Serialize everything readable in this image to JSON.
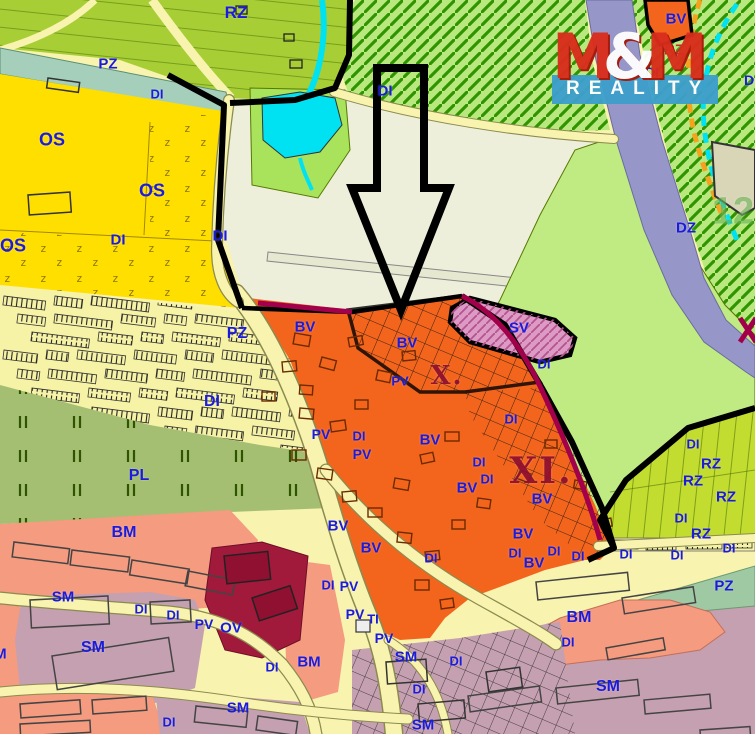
{
  "logo": {
    "m1": "M",
    "amp": "&",
    "m2": "M",
    "tagline": "REALITY"
  },
  "zone_colors": {
    "os_yellow": "#FFDF00",
    "bv_orange": "#F3651D",
    "sv_pink": "#DC9AC4",
    "sm_mauve": "#C5A0B0",
    "bm_salmon": "#F49B80",
    "ov_crimson": "#A11A3B",
    "pl_olive": "#A4BE72",
    "rz_top": "#A8CE35",
    "rz_garden": "#C3DC30",
    "dz_purple": "#9697C8",
    "pz_teal": "#A5CFBA",
    "pz_sage": "#9FC9A3",
    "cream_field": "#EDEFDA",
    "hatch_green": "#B9E87E",
    "light_green": "#BFEB82",
    "road_yellow": "#F8F3AE",
    "water_cyan": "#00E2F2",
    "label_blue": "#1B1BDC",
    "roman_red": "#8E0F30",
    "change_boundary": "#A3004B"
  },
  "labels": [
    {
      "t": "PZ",
      "x": 108,
      "y": 64
    },
    {
      "t": "DI",
      "x": 157,
      "y": 94,
      "s": 13
    },
    {
      "t": "RZ",
      "x": 236,
      "y": 13,
      "s": 17
    },
    {
      "t": "DI",
      "x": 385,
      "y": 91
    },
    {
      "t": "BV",
      "x": 676,
      "y": 19
    },
    {
      "t": "RZ",
      "x": 674,
      "y": 50,
      "c": "red"
    },
    {
      "t": "DI",
      "x": 652,
      "y": 72,
      "s": 14
    },
    {
      "t": "DI",
      "x": 751,
      "y": 80,
      "s": 14
    },
    {
      "t": "DZ",
      "x": 686,
      "y": 228
    },
    {
      "t": "OS",
      "x": 52,
      "y": 140,
      "s": 18
    },
    {
      "t": "OS",
      "x": 152,
      "y": 191,
      "s": 18
    },
    {
      "t": "OS",
      "x": 13,
      "y": 246,
      "s": 18
    },
    {
      "t": "DI",
      "x": 118,
      "y": 240
    },
    {
      "t": "DI",
      "x": 220,
      "y": 236
    },
    {
      "t": "DI",
      "x": 212,
      "y": 402,
      "s": 16
    },
    {
      "t": "PZ",
      "x": 237,
      "y": 334,
      "s": 16
    },
    {
      "t": "BV",
      "x": 305,
      "y": 327
    },
    {
      "t": "BV",
      "x": 407,
      "y": 343
    },
    {
      "t": "PV",
      "x": 400,
      "y": 381,
      "s": 13
    },
    {
      "t": "SV",
      "x": 519,
      "y": 328
    },
    {
      "t": "DI",
      "x": 544,
      "y": 364,
      "s": 13
    },
    {
      "t": "DI",
      "x": 511,
      "y": 419,
      "s": 13
    },
    {
      "t": "PV",
      "x": 321,
      "y": 434,
      "s": 14
    },
    {
      "t": "DI",
      "x": 359,
      "y": 436,
      "s": 13
    },
    {
      "t": "PV",
      "x": 362,
      "y": 454,
      "s": 14
    },
    {
      "t": "BV",
      "x": 430,
      "y": 440
    },
    {
      "t": "DI",
      "x": 479,
      "y": 462,
      "s": 13
    },
    {
      "t": "DI",
      "x": 487,
      "y": 479,
      "s": 13
    },
    {
      "t": "BV",
      "x": 467,
      "y": 488
    },
    {
      "t": "BV",
      "x": 542,
      "y": 499
    },
    {
      "t": "BV",
      "x": 338,
      "y": 526
    },
    {
      "t": "BV",
      "x": 371,
      "y": 548
    },
    {
      "t": "DI",
      "x": 431,
      "y": 558,
      "s": 13
    },
    {
      "t": "BV",
      "x": 523,
      "y": 534
    },
    {
      "t": "DI",
      "x": 515,
      "y": 553,
      "s": 13
    },
    {
      "t": "BV",
      "x": 534,
      "y": 563
    },
    {
      "t": "DI",
      "x": 554,
      "y": 551,
      "s": 13
    },
    {
      "t": "DI",
      "x": 578,
      "y": 556,
      "s": 13
    },
    {
      "t": "DI",
      "x": 693,
      "y": 444,
      "s": 13
    },
    {
      "t": "RZ",
      "x": 711,
      "y": 464
    },
    {
      "t": "RZ",
      "x": 693,
      "y": 481
    },
    {
      "t": "RZ",
      "x": 726,
      "y": 497
    },
    {
      "t": "DI",
      "x": 681,
      "y": 518,
      "s": 13
    },
    {
      "t": "RZ",
      "x": 701,
      "y": 534
    },
    {
      "t": "DI",
      "x": 626,
      "y": 554,
      "s": 13
    },
    {
      "t": "DI",
      "x": 677,
      "y": 555,
      "s": 13
    },
    {
      "t": "DI",
      "x": 729,
      "y": 548,
      "s": 13
    },
    {
      "t": "PZ",
      "x": 724,
      "y": 586
    },
    {
      "t": "PL",
      "x": 139,
      "y": 476,
      "s": 16
    },
    {
      "t": "BM",
      "x": 124,
      "y": 533,
      "s": 16
    },
    {
      "t": "SM",
      "x": 63,
      "y": 597
    },
    {
      "t": "SM",
      "x": 93,
      "y": 648,
      "s": 16
    },
    {
      "t": "DI",
      "x": 141,
      "y": 609,
      "s": 13
    },
    {
      "t": "DI",
      "x": 173,
      "y": 615,
      "s": 13
    },
    {
      "t": "PV",
      "x": 204,
      "y": 624,
      "s": 14
    },
    {
      "t": "OV",
      "x": 231,
      "y": 628
    },
    {
      "t": "BM",
      "x": -5,
      "y": 654
    },
    {
      "t": "SM",
      "x": 238,
      "y": 708
    },
    {
      "t": "DI",
      "x": 169,
      "y": 722,
      "s": 13
    },
    {
      "t": "DI",
      "x": 328,
      "y": 585,
      "s": 13
    },
    {
      "t": "PV",
      "x": 349,
      "y": 586,
      "s": 14
    },
    {
      "t": "PV",
      "x": 355,
      "y": 614,
      "s": 14
    },
    {
      "t": "TI",
      "x": 373,
      "y": 619,
      "s": 13
    },
    {
      "t": "PV",
      "x": 384,
      "y": 638,
      "s": 14
    },
    {
      "t": "BM",
      "x": 309,
      "y": 662
    },
    {
      "t": "DI",
      "x": 272,
      "y": 667,
      "s": 13
    },
    {
      "t": "SM",
      "x": 406,
      "y": 657
    },
    {
      "t": "DI",
      "x": 456,
      "y": 661,
      "s": 13
    },
    {
      "t": "DI",
      "x": 419,
      "y": 689,
      "s": 13
    },
    {
      "t": "SM",
      "x": 423,
      "y": 725
    },
    {
      "t": "BM",
      "x": 579,
      "y": 618,
      "s": 16
    },
    {
      "t": "DI",
      "x": 568,
      "y": 642,
      "s": 13
    },
    {
      "t": "SM",
      "x": 608,
      "y": 687,
      "s": 16
    }
  ],
  "romans": [
    {
      "t": "X.",
      "x": 447,
      "y": 376,
      "s": 26
    },
    {
      "t": "XI.",
      "x": 541,
      "y": 471,
      "s": 36
    }
  ],
  "watermark": [
    {
      "t": "12",
      "x": 733,
      "y": 212,
      "s": 38
    }
  ]
}
